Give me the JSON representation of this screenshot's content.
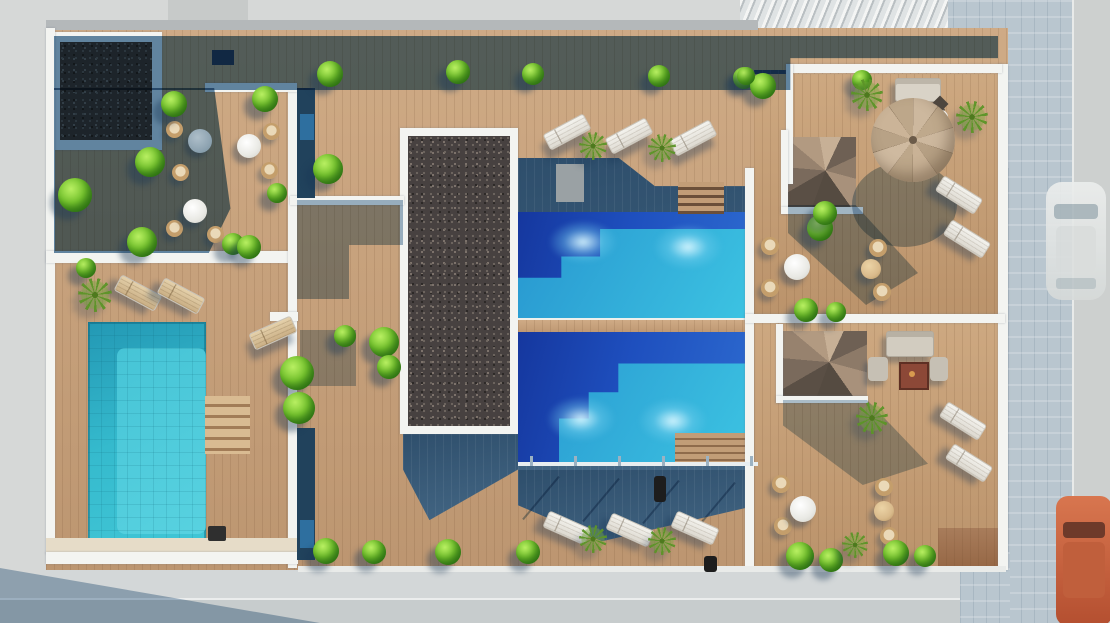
{
  "scene": {
    "description": "Aerial 3D architectural rendering of a residential rooftop pool deck: two shared lap pools with sky-blue water, a private turquoise plunge pool on the left terrace, timber decking, two dark gravel planters, cafe seating, sun loungers, a beige parasol, two spiral staircases, lounge sets with a fire table, rows of round green shrubs and palms, and a street with a parked white car and an orange car on the right.",
    "palette": {
      "wood_sunlit": "#c7a07a",
      "wood_shadow": "#3a5f7e",
      "pool_deep_blue": "#1e4fbe",
      "pool_turquoise": "#3cc3e2",
      "plunge_pool_cyan": "#35bacd",
      "gravel": "#474140",
      "vegetation_green": "#76c42e",
      "walls_white": "#f3f4f1",
      "paving_blue_gray": "#b9c6cf",
      "street_gray": "#d6d8d7",
      "parasol_tan": "#c9b59a",
      "car_orange": "#c86a4a",
      "car_white": "#e6e8e7"
    },
    "inventory": {
      "pools": 3,
      "gravel_planters": 2,
      "spiral_staircases": 2,
      "parasols": 1,
      "sun_loungers": 13,
      "cafe_chairs": 14,
      "round_tables": 8,
      "lounge_sofas": 2,
      "fire_tables": 1,
      "parked_cars": 2
    },
    "objects": [
      {
        "type": "lounger",
        "x": 566,
        "y": 131,
        "r": -28
      },
      {
        "type": "lounger",
        "x": 628,
        "y": 135,
        "r": -28
      },
      {
        "type": "lounger",
        "x": 692,
        "y": 137,
        "r": -28
      },
      {
        "type": "lounger",
        "x": 566,
        "y": 527,
        "r": 24
      },
      {
        "type": "lounger",
        "x": 629,
        "y": 529,
        "r": 24
      },
      {
        "type": "lounger",
        "x": 694,
        "y": 527,
        "r": 24
      },
      {
        "type": "lounger",
        "x": 958,
        "y": 194,
        "r": 32
      },
      {
        "type": "lounger",
        "x": 966,
        "y": 238,
        "r": 32
      },
      {
        "type": "lounger",
        "x": 962,
        "y": 420,
        "r": 32
      },
      {
        "type": "lounger",
        "x": 968,
        "y": 462,
        "r": 32
      },
      {
        "type": "lounger",
        "variant": "tan",
        "x": 137,
        "y": 292,
        "r": 28
      },
      {
        "type": "lounger",
        "variant": "tan",
        "x": 180,
        "y": 295,
        "r": 28
      },
      {
        "type": "lounger",
        "variant": "tan",
        "x": 272,
        "y": 332,
        "r": -24
      },
      {
        "type": "chair",
        "x": 174,
        "y": 129,
        "s": 17
      },
      {
        "type": "chair",
        "x": 180,
        "y": 172,
        "s": 17
      },
      {
        "type": "chair",
        "x": 271,
        "y": 131,
        "s": 17
      },
      {
        "type": "chair",
        "x": 269,
        "y": 170,
        "s": 17
      },
      {
        "type": "chair",
        "x": 174,
        "y": 228,
        "s": 17
      },
      {
        "type": "chair",
        "x": 215,
        "y": 234,
        "s": 17
      },
      {
        "type": "chair",
        "x": 770,
        "y": 246,
        "s": 18
      },
      {
        "type": "chair",
        "x": 770,
        "y": 288,
        "s": 18
      },
      {
        "type": "chair",
        "x": 878,
        "y": 248,
        "s": 18
      },
      {
        "type": "chair",
        "x": 882,
        "y": 292,
        "s": 18
      },
      {
        "type": "chair",
        "x": 781,
        "y": 484,
        "s": 18
      },
      {
        "type": "chair",
        "x": 783,
        "y": 526,
        "s": 18
      },
      {
        "type": "chair",
        "x": 884,
        "y": 487,
        "s": 18
      },
      {
        "type": "chair",
        "x": 889,
        "y": 536,
        "s": 18
      },
      {
        "type": "table",
        "variant": "shaded",
        "x": 200,
        "y": 141,
        "s": 24
      },
      {
        "type": "table",
        "variant": "white",
        "x": 249,
        "y": 146,
        "s": 24
      },
      {
        "type": "table",
        "variant": "white",
        "x": 195,
        "y": 211,
        "s": 24
      },
      {
        "type": "table",
        "variant": "white",
        "x": 797,
        "y": 267,
        "s": 26
      },
      {
        "type": "table",
        "variant": "white",
        "x": 803,
        "y": 509,
        "s": 26
      },
      {
        "type": "table",
        "variant": "white",
        "x": 941,
        "y": 117,
        "s": 14
      },
      {
        "type": "table",
        "variant": "tan",
        "x": 871,
        "y": 269,
        "s": 20
      },
      {
        "type": "table",
        "variant": "tan",
        "x": 884,
        "y": 511,
        "s": 20
      },
      {
        "type": "bush",
        "x": 330,
        "y": 74,
        "s": 26
      },
      {
        "type": "bush",
        "x": 458,
        "y": 72,
        "s": 24
      },
      {
        "type": "bush",
        "x": 533,
        "y": 74,
        "s": 22
      },
      {
        "type": "bush",
        "x": 659,
        "y": 76,
        "s": 22
      },
      {
        "type": "bush",
        "x": 744,
        "y": 78,
        "s": 22
      },
      {
        "type": "bush",
        "x": 862,
        "y": 80,
        "s": 20
      },
      {
        "type": "bush",
        "x": 763,
        "y": 86,
        "s": 26
      },
      {
        "type": "bush",
        "x": 746,
        "y": 76,
        "s": 18
      },
      {
        "type": "bush",
        "x": 174,
        "y": 104,
        "s": 26
      },
      {
        "type": "bush",
        "x": 265,
        "y": 99,
        "s": 26
      },
      {
        "type": "bush",
        "x": 150,
        "y": 162,
        "s": 30
      },
      {
        "type": "bush",
        "x": 75,
        "y": 195,
        "s": 34
      },
      {
        "type": "bush",
        "x": 142,
        "y": 242,
        "s": 30
      },
      {
        "type": "bush",
        "x": 277,
        "y": 193,
        "s": 20
      },
      {
        "type": "bush",
        "x": 233,
        "y": 244,
        "s": 22
      },
      {
        "type": "bush",
        "x": 328,
        "y": 169,
        "s": 30
      },
      {
        "type": "bush",
        "x": 249,
        "y": 247,
        "s": 24
      },
      {
        "type": "bush",
        "x": 345,
        "y": 336,
        "s": 22
      },
      {
        "type": "bush",
        "x": 384,
        "y": 342,
        "s": 30
      },
      {
        "type": "bush",
        "x": 389,
        "y": 367,
        "s": 24
      },
      {
        "type": "bush",
        "x": 297,
        "y": 373,
        "s": 34
      },
      {
        "type": "bush",
        "x": 299,
        "y": 408,
        "s": 32
      },
      {
        "type": "bush",
        "x": 86,
        "y": 268,
        "s": 20
      },
      {
        "type": "bush",
        "x": 326,
        "y": 551,
        "s": 26
      },
      {
        "type": "bush",
        "x": 374,
        "y": 552,
        "s": 24
      },
      {
        "type": "bush",
        "x": 448,
        "y": 552,
        "s": 26
      },
      {
        "type": "bush",
        "x": 528,
        "y": 552,
        "s": 24
      },
      {
        "type": "bush",
        "x": 820,
        "y": 228,
        "s": 26
      },
      {
        "type": "bush",
        "x": 825,
        "y": 213,
        "s": 24
      },
      {
        "type": "bush",
        "x": 806,
        "y": 310,
        "s": 24
      },
      {
        "type": "bush",
        "x": 836,
        "y": 312,
        "s": 20
      },
      {
        "type": "bush",
        "x": 800,
        "y": 556,
        "s": 28
      },
      {
        "type": "bush",
        "x": 831,
        "y": 560,
        "s": 24
      },
      {
        "type": "bush",
        "x": 896,
        "y": 553,
        "s": 26
      },
      {
        "type": "bush",
        "x": 925,
        "y": 556,
        "s": 22
      },
      {
        "type": "palm",
        "x": 593,
        "y": 146,
        "s": 28
      },
      {
        "type": "palm",
        "x": 662,
        "y": 148,
        "s": 28
      },
      {
        "type": "palm",
        "x": 593,
        "y": 539,
        "s": 28
      },
      {
        "type": "palm",
        "x": 662,
        "y": 541,
        "s": 28
      },
      {
        "type": "palm",
        "x": 867,
        "y": 95,
        "s": 32
      },
      {
        "type": "palm",
        "x": 972,
        "y": 117,
        "s": 32
      },
      {
        "type": "palm",
        "x": 872,
        "y": 418,
        "s": 32
      },
      {
        "type": "palm",
        "x": 855,
        "y": 545,
        "s": 26
      },
      {
        "type": "palm",
        "x": 95,
        "y": 295,
        "s": 34
      }
    ]
  }
}
